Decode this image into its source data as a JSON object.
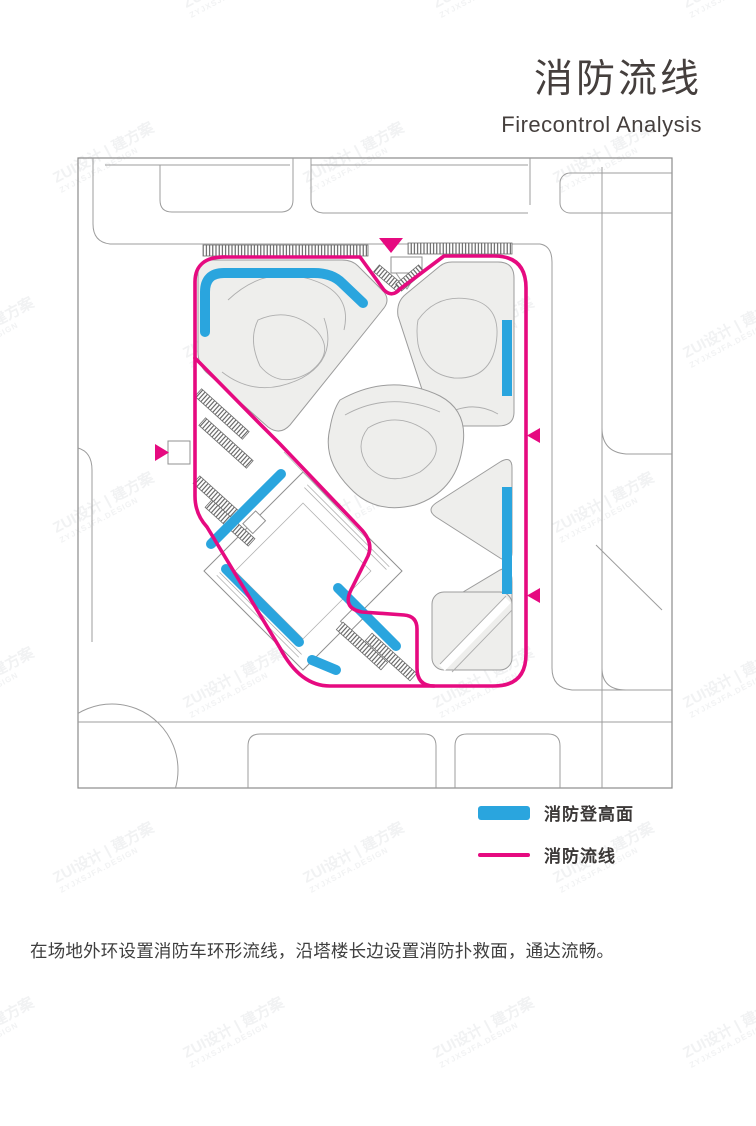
{
  "title": {
    "zh": "消防流线",
    "en": "Firecontrol Analysis"
  },
  "legend": {
    "items": [
      {
        "swatch": "thick-bar",
        "color": "#2aa5de",
        "label": "消防登高面"
      },
      {
        "swatch": "thin-line",
        "color": "#e60a80",
        "label": "消防流线"
      }
    ]
  },
  "description": "在场地外环设置消防车环形流线，沿塔楼长边设置消防扑救面，通达流畅。",
  "plan": {
    "entrance_arrows": [
      {
        "position": "top-center",
        "direction": "down"
      },
      {
        "position": "left-middle",
        "direction": "right"
      },
      {
        "position": "right-upper",
        "direction": "left"
      },
      {
        "position": "right-lower",
        "direction": "left"
      }
    ],
    "route_type": "ring fire-truck loop around site with branch around tower",
    "fire_access_bars_count": 7
  },
  "watermark": {
    "text": "ZUI设计 | 建方案",
    "subtext": "ZYJXSJFA.DESIGN"
  },
  "colors": {
    "fire_access_blue": "#2aa5de",
    "fire_route_pink": "#e60a80",
    "site_fill": "#eeeeec",
    "road_gray": "#9c9c9c"
  }
}
